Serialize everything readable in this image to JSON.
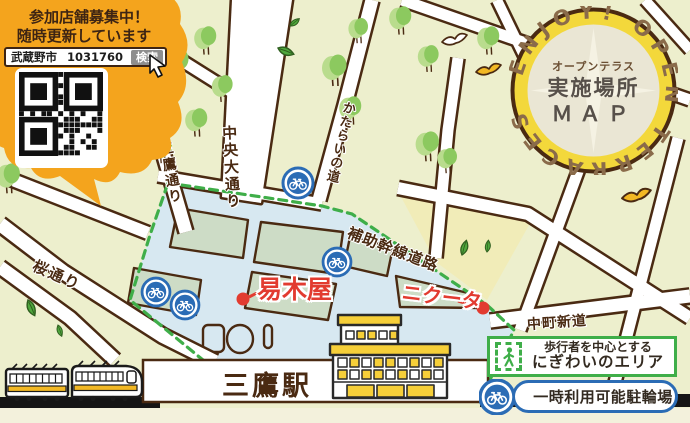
{
  "title": "オープンテラス実施場所MAP",
  "bubble": {
    "line1": "参加店舗募集中！",
    "line2": "随時更新しています",
    "search_city": "武蔵野市",
    "search_code": "1031760",
    "search_button": "検索"
  },
  "badge": {
    "ring_text": "ENJOY! OPEN TERRACES",
    "subtitle": "オープンテラス",
    "title": "実施場所",
    "map_word": "ＭＡＰ"
  },
  "streets": {
    "chuo_odori": "中央大通り",
    "mitaka_dori": "三鷹通り",
    "katarai_no_michi": "かたらいの道",
    "hojokansen_doro": "補助幹線道路",
    "sakura_dori": "桜通り",
    "nakacho_shindo": "中町新道"
  },
  "shops": {
    "shop1": "易木屋",
    "shop2": "ニクータ"
  },
  "station": {
    "name": "三鷹駅"
  },
  "legend": {
    "area_line1": "歩行者を中心とする",
    "area_line2": "にぎわいのエリア",
    "bicycle": "一時利用可能駐輪場"
  },
  "icons": {
    "bicycle": "bicycle-parking-icon",
    "pedestrian": "pedestrian-icon",
    "qr": "qr-code",
    "cursor": "cursor-icon",
    "train": "train-illustration",
    "birds": [
      "white-bird-icon",
      "yellow-bird-icon"
    ]
  },
  "colors": {
    "bubble_orange": "#F4A41D",
    "map_bg": "#EDEFCD",
    "zone_blue": "#D7E8F1",
    "block_sage": "#CDDCC6",
    "road_outline": "#4A2A12",
    "dash_green": "#3FAE49",
    "marker_red": "#E23B30",
    "bike_blue": "#2B6CB5",
    "badge_yellow": "#F3D83B",
    "badge_inner": "#EAE6D4",
    "train_yellow": "#F2B824"
  }
}
